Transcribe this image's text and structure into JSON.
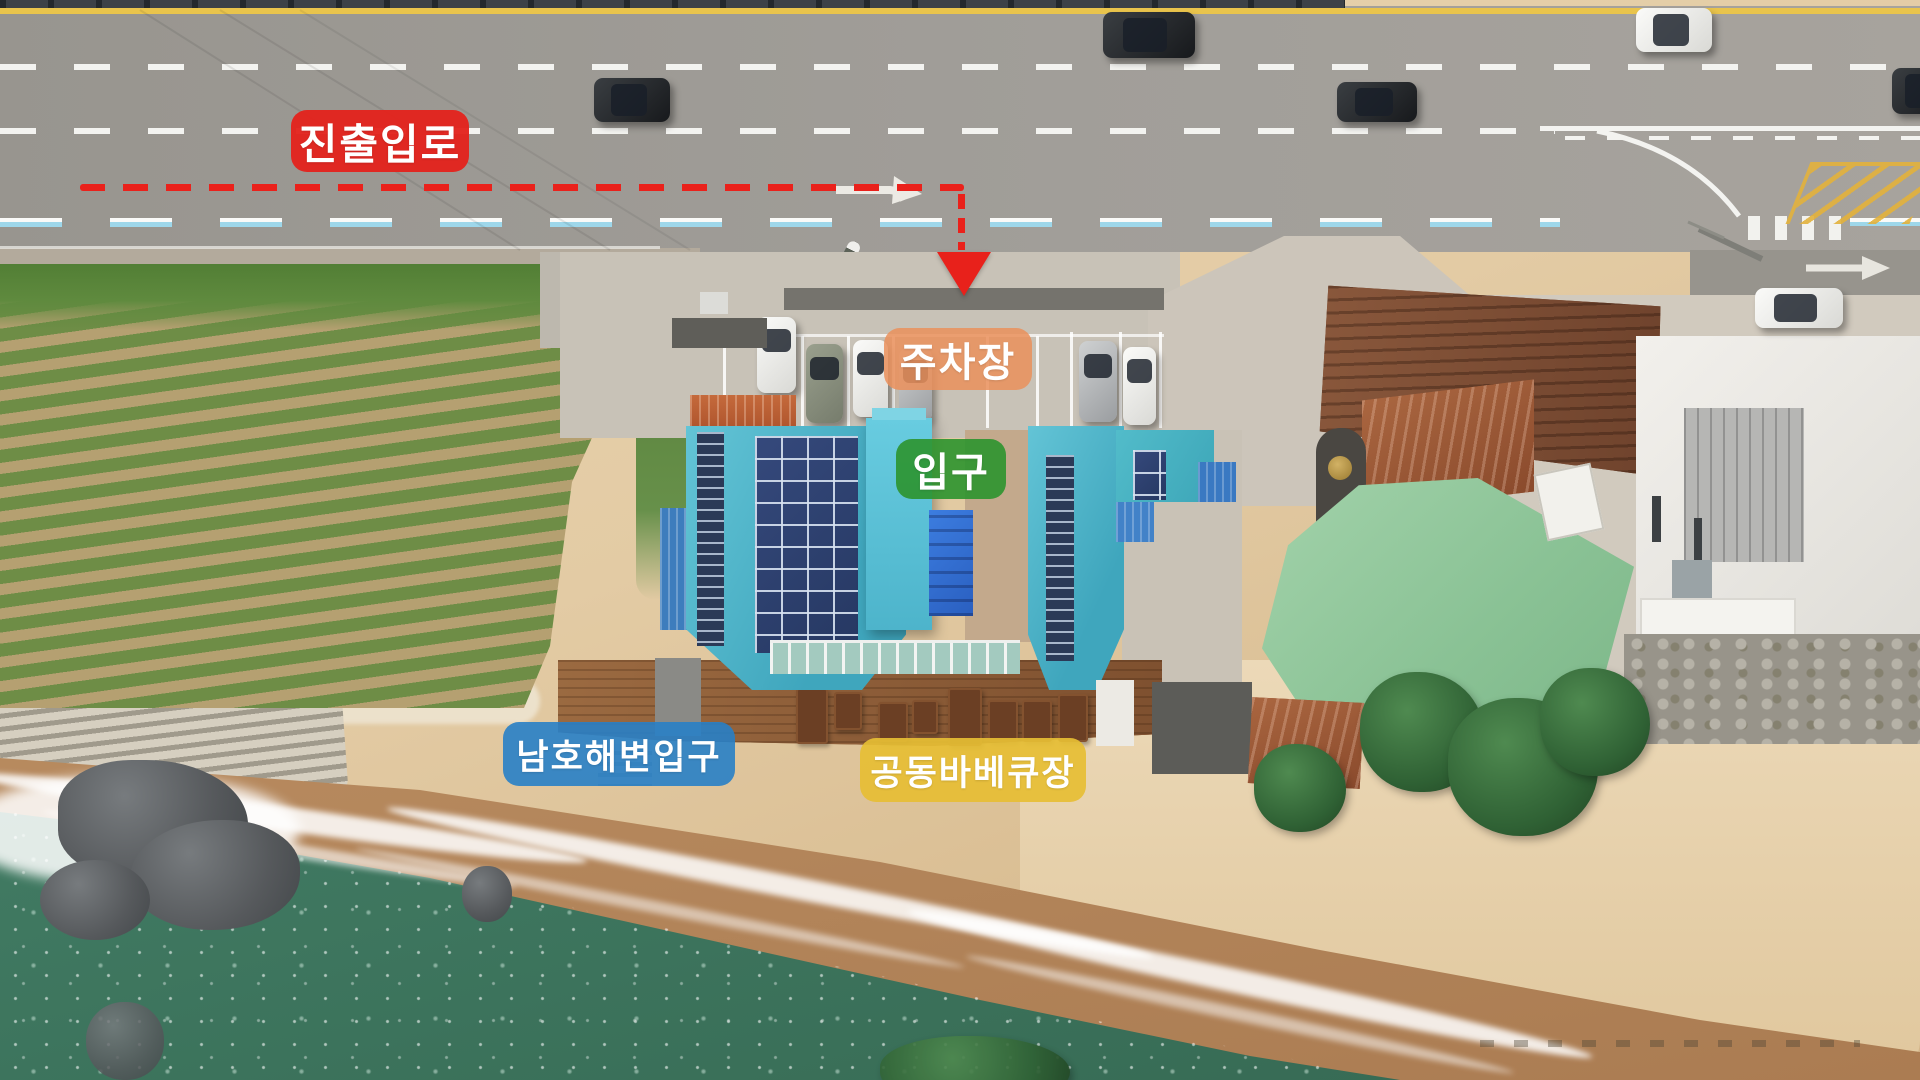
{
  "labels": {
    "route_access": {
      "text": "진출입로",
      "bg": "#e3231d"
    },
    "parking": {
      "text": "주차장",
      "bg": "#ea905c"
    },
    "entrance": {
      "text": "입구",
      "bg": "#2c942e"
    },
    "beach_entrance": {
      "text": "남호해변입구",
      "bg": "#287fc6"
    },
    "bbq": {
      "text": "공동바베큐장",
      "bg": "#e6be34"
    }
  },
  "route": {
    "line_color": "#ea211b",
    "style": "dashed",
    "arrow_icon": "down-arrow",
    "path": "along road from left, turning down into parking lot"
  }
}
